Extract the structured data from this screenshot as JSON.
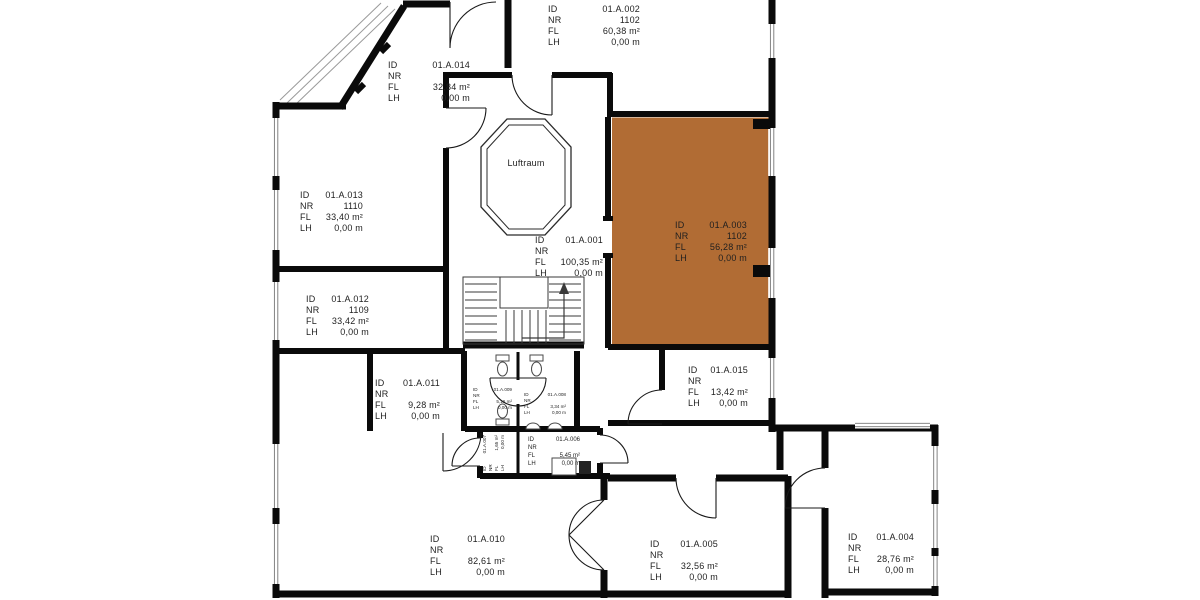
{
  "plan": {
    "atrium_label": "Luftraum",
    "colors": {
      "highlight_fill": "#b16c34",
      "highlight_text": "#7d4717",
      "wall": "#0a0a0a"
    }
  },
  "label_keys": {
    "id": "ID",
    "nr": "NR",
    "fl": "FL",
    "lh": "LH"
  },
  "rooms": {
    "a001": {
      "id": "01.A.001",
      "nr": "",
      "fl": "100,35 m²",
      "lh": "0,00 m"
    },
    "a002": {
      "id": "01.A.002",
      "nr": "1102",
      "fl": "60,38 m²",
      "lh": "0,00 m"
    },
    "a003": {
      "id": "01.A.003",
      "nr": "1102",
      "fl": "56,28 m²",
      "lh": "0,00 m",
      "highlighted": true
    },
    "a004": {
      "id": "01.A.004",
      "nr": "",
      "fl": "28,76 m²",
      "lh": "0,00 m"
    },
    "a005": {
      "id": "01.A.005",
      "nr": "",
      "fl": "32,56 m²",
      "lh": "0,00 m"
    },
    "a006": {
      "id": "01.A.006",
      "nr": "",
      "fl": "5,45 m²",
      "lh": "0,00 m"
    },
    "a007": {
      "id": "01.A.007",
      "nr": "",
      "fl": "1,65 m²",
      "lh": "0,00 m"
    },
    "a008": {
      "id": "01.A.008",
      "nr": "",
      "fl": "3,34 m²",
      "lh": "0,00 m"
    },
    "a009": {
      "id": "01.A.009",
      "nr": "",
      "fl": "5,16 m²",
      "lh": "0,00 m"
    },
    "a010": {
      "id": "01.A.010",
      "nr": "",
      "fl": "82,61 m²",
      "lh": "0,00 m"
    },
    "a011": {
      "id": "01.A.011",
      "nr": "",
      "fl": "9,28 m²",
      "lh": "0,00 m"
    },
    "a012": {
      "id": "01.A.012",
      "nr": "1109",
      "fl": "33,42 m²",
      "lh": "0,00 m"
    },
    "a013": {
      "id": "01.A.013",
      "nr": "1110",
      "fl": "33,40 m²",
      "lh": "0,00 m"
    },
    "a014": {
      "id": "01.A.014",
      "nr": "",
      "fl": "32,84 m²",
      "lh": "0,00 m"
    },
    "a015": {
      "id": "01.A.015",
      "nr": "",
      "fl": "13,42 m²",
      "lh": "0,00 m"
    }
  }
}
